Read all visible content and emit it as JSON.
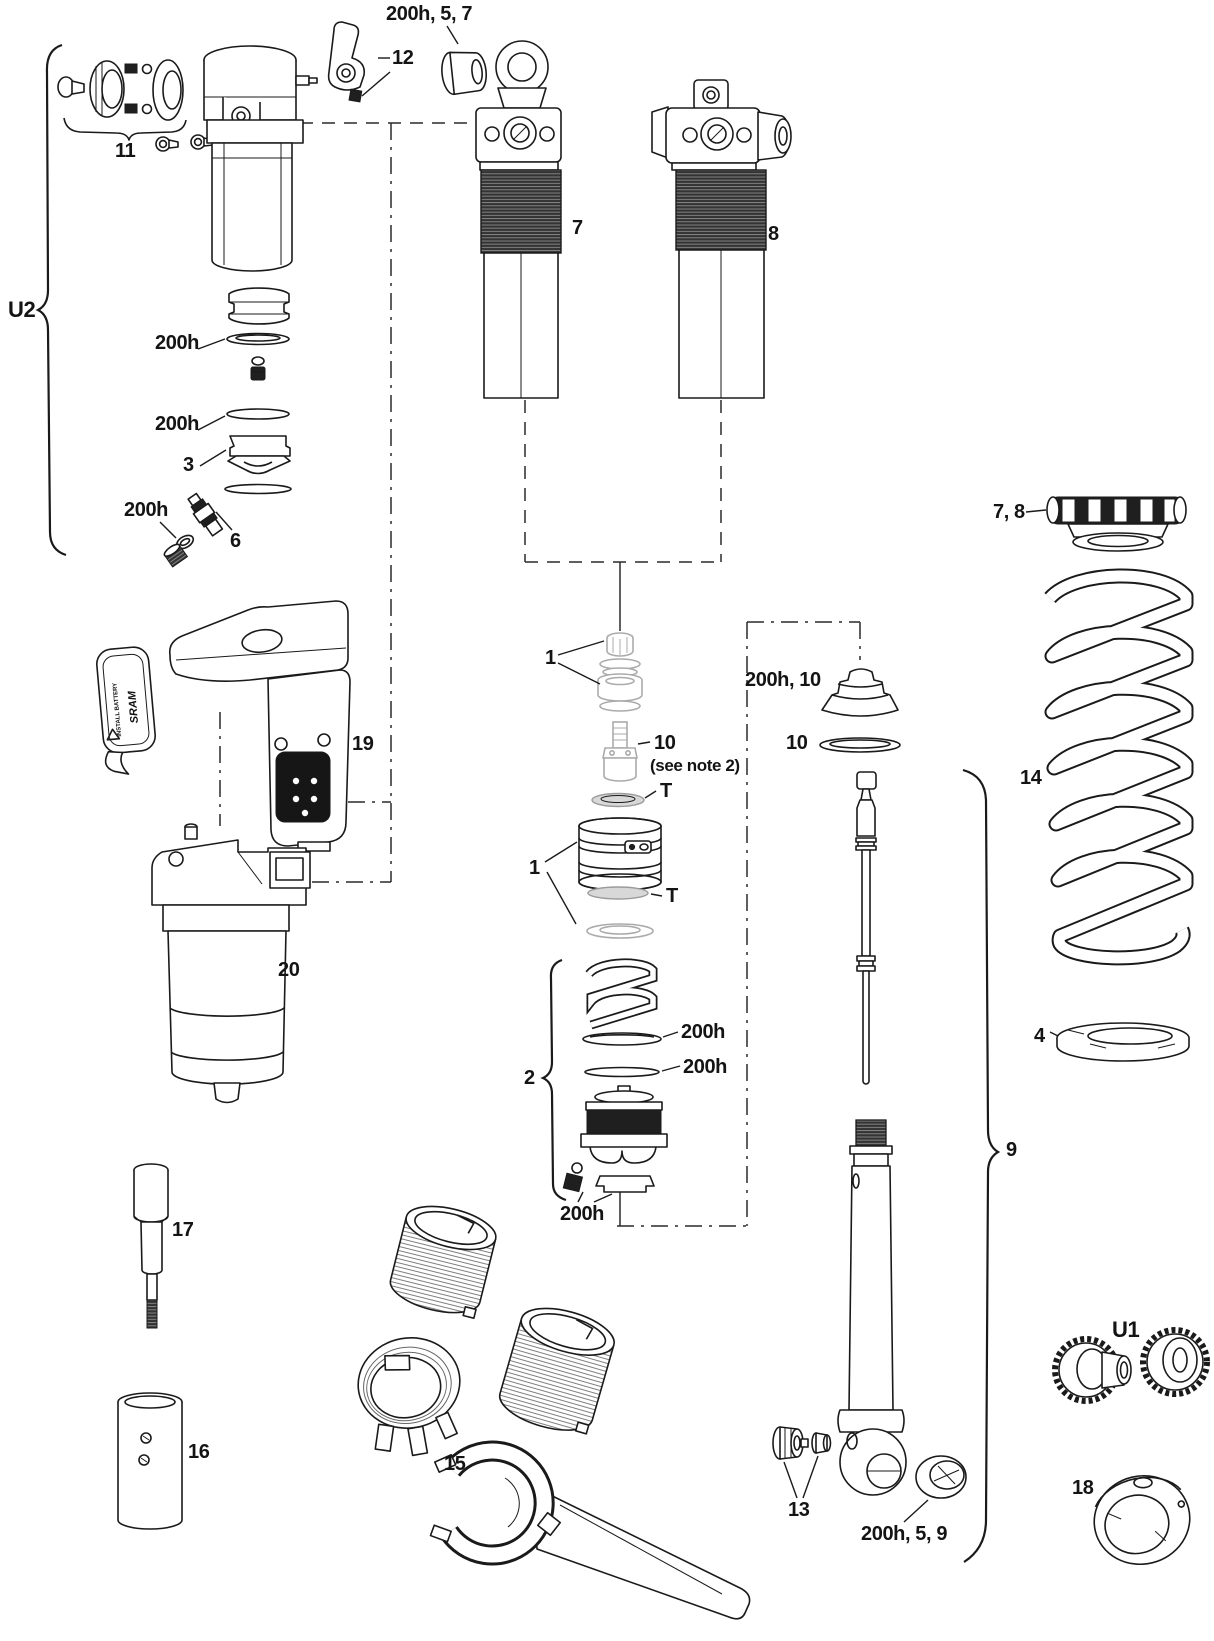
{
  "diagram": {
    "type": "exploded-parts-diagram",
    "labels": {
      "top_hardware": "200h, 5, 7",
      "lever": "12",
      "mount_hardware": "11",
      "bracket_u2": "U2",
      "oring_left_upper": "200h",
      "oring_left_lower": "200h",
      "seal_head": "3",
      "oring_valve": "200h",
      "air_valve": "6",
      "body_trunnion": "7",
      "body_standard": "8",
      "spring_collar": "7, 8",
      "coil_spring": "14",
      "spring_seat": "4",
      "piston_upper": "1",
      "valve_core": "10",
      "valve_core_note": "(see note 2)",
      "t_washer_upper": "T",
      "piston_lower": "1",
      "t_washer_lower": "T",
      "seal_kit_upper": "200h, 10",
      "washer_ten": "10",
      "rebound_assembly": "2",
      "oring_mid_upper": "200h",
      "oring_mid_lower": "200h",
      "oring_bottom": "200h",
      "control_module": "19",
      "reservoir": "20",
      "tool_rod": "17",
      "tool_tube": "16",
      "tool_wrench": "15",
      "shaft_nut": "13",
      "eyelet_bushing": "200h, 5, 9",
      "bracket_u1": "U1",
      "retainer_cup": "18",
      "damper_assembly": "9",
      "battery_install": "INSTALL BATTERY",
      "battery_brand": "SRAM"
    }
  }
}
